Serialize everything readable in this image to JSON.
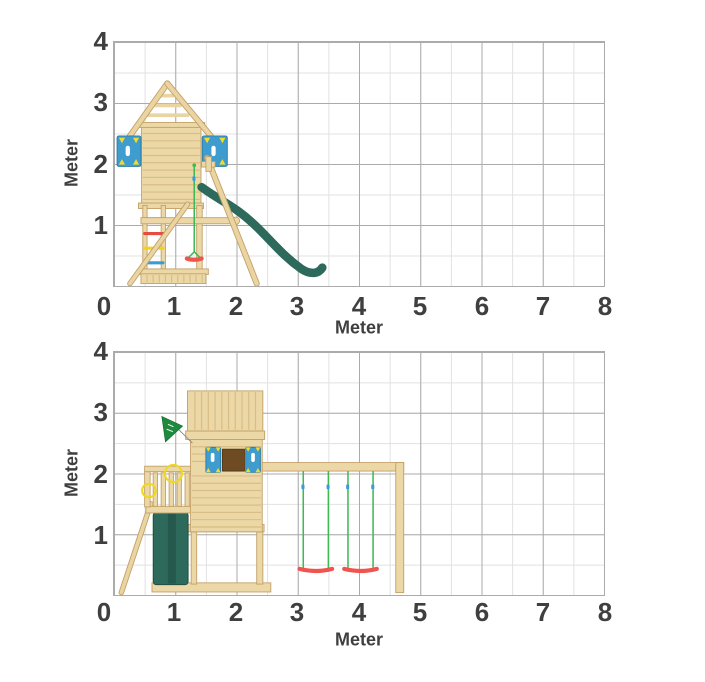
{
  "page": {
    "background": "#ffffff",
    "text_color": "#3f3f3f"
  },
  "charts": [
    {
      "name": "playtower-side-view-with-slide",
      "xlabel": "Meter",
      "ylabel": "Meter",
      "x_ticks": [
        "0",
        "1",
        "2",
        "3",
        "4",
        "5",
        "6",
        "7",
        "8"
      ],
      "y_ticks": [
        "4",
        "3",
        "2",
        "1"
      ]
    },
    {
      "name": "playtower-front-view-with-swings",
      "xlabel": "Meter",
      "ylabel": "Meter",
      "x_ticks": [
        "0",
        "1",
        "2",
        "3",
        "4",
        "5",
        "6",
        "7",
        "8"
      ],
      "y_ticks": [
        "4",
        "3",
        "2",
        "1"
      ]
    }
  ],
  "chart_data": [
    {
      "type": "diagram",
      "subject": "Wooden climbing tower with gable roof, climbing panels, ladder, trapeze and slide (side elevation, dimensions in meters)",
      "xlabel": "Meter",
      "ylabel": "Meter",
      "xlim": [
        0,
        8
      ],
      "ylim": [
        0,
        4
      ],
      "x_ticks": [
        0,
        1,
        2,
        3,
        4,
        5,
        6,
        7,
        8
      ],
      "y_ticks": [
        0,
        1,
        2,
        3,
        4
      ],
      "grid": {
        "major_step_m": 1.0,
        "minor_step_m": 0.5,
        "on": true
      },
      "key_dimensions_m": {
        "roof_peak_height": 3.3,
        "roof_eave_height": 2.5,
        "tower_wall_x": [
          0.45,
          1.42
        ],
        "tower_wall_y": [
          1.3,
          2.62
        ],
        "climbing_panel_y": [
          1.95,
          2.45
        ],
        "beam_height": 1.1,
        "ladder_rung_heights": [
          1.1,
          0.85,
          0.6,
          0.35
        ],
        "trapeze_bar_height": 0.45,
        "slide_top": [
          1.43,
          1.6
        ],
        "slide_end": [
          3.4,
          0.15
        ],
        "footprint_x": [
          0.26,
          3.4
        ]
      },
      "colors": {
        "wood": "#ECD8A6",
        "slide": "#2D6A5B",
        "panel_blue": "#3E9CCE",
        "rung_green": "#30A44F",
        "rung_red": "#E64C3F",
        "rung_yellow": "#F2D21B",
        "rung_blue": "#3D9BD3",
        "rope_green": "#3FB954",
        "trapeze_red": "#F0544F"
      }
    },
    {
      "type": "diagram",
      "subject": "Wooden playtower with crow's nest, window shutters, flag, tarp slide bay, platform railing and double swing extension (front elevation, dimensions in meters)",
      "xlabel": "Meter",
      "ylabel": "Meter",
      "xlim": [
        0,
        8
      ],
      "ylim": [
        0,
        4
      ],
      "x_ticks": [
        0,
        1,
        2,
        3,
        4,
        5,
        6,
        7,
        8
      ],
      "y_ticks": [
        0,
        1,
        2,
        3,
        4
      ],
      "grid": {
        "major_step_m": 1.0,
        "minor_step_m": 0.5,
        "on": true
      },
      "key_dimensions_m": {
        "top_box_height": 3.34,
        "top_box_x": [
          1.2,
          2.43
        ],
        "tower_wall_x": [
          1.25,
          2.42
        ],
        "window_y": [
          2.02,
          2.43
        ],
        "swing_beam_height": 2.18,
        "swing_beam_x": [
          2.42,
          4.73
        ],
        "swing_seat_height": 0.4,
        "swing1_ropes_x": [
          3.09,
          3.5
        ],
        "swing2_ropes_x": [
          3.82,
          4.23
        ],
        "railing_y": [
          1.45,
          2.12
        ],
        "tarp_x": [
          0.64,
          1.21
        ],
        "footprint_x": [
          0.12,
          4.73
        ]
      },
      "colors": {
        "wood": "#ECD8A6",
        "tarp": "#2D6A5B",
        "panel_blue": "#3E9CCE",
        "flag_green": "#1F8A3E",
        "window_brown": "#6E4B23",
        "rope_green": "#3FB954",
        "seat_red": "#F0544F",
        "ring_yellow": "#EED821"
      }
    }
  ]
}
